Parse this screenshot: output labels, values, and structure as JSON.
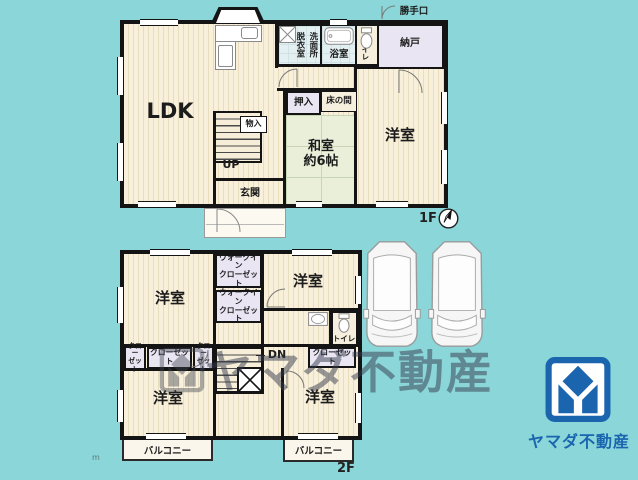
{
  "colors": {
    "background": "#8ad6d8",
    "wall": "#141414",
    "floor": "#f8f0da",
    "tatami": "#e9efd9",
    "closet": "#e9e5f3",
    "wet_area": "#e3eff1",
    "logo_blue": "#1b65af"
  },
  "floor1": {
    "label": "1F",
    "rooms": {
      "ldk": "LDK",
      "datsui": "脱衣室",
      "senmen": "洗面所",
      "bath": "浴室",
      "toilet": "トイレ",
      "nando": "納戸",
      "katteguchi": "勝手口",
      "oshiire": "押入",
      "tokonoma": "床の間",
      "washitsu": "和室\n約6帖",
      "yoshitsu": "洋室",
      "monoire": "物入",
      "up": "UP",
      "genkan": "玄関"
    }
  },
  "floor2": {
    "label": "2F",
    "rooms": {
      "yoshitsu_nw": "洋室",
      "yoshitsu_ne": "洋室",
      "yoshitsu_sw": "洋室",
      "yoshitsu_se": "洋室",
      "wic1": "ウォークイン\nクローゼット",
      "wic2": "ウォークイン\nクローゼット",
      "closet_a": "クロー\nゼット",
      "closet_b": "クローゼット",
      "closet_c": "クロー\nゼット",
      "closet_d": "クローゼット",
      "toilet": "トイレ",
      "dn": "DN",
      "balcony_left": "バルコニー",
      "balcony_right": "バルコニー"
    }
  },
  "watermark": {
    "text": "ヤマダ不動産"
  },
  "logo": {
    "text": "ヤマダ不動産"
  },
  "annotations": {
    "scale_mark": "m"
  }
}
